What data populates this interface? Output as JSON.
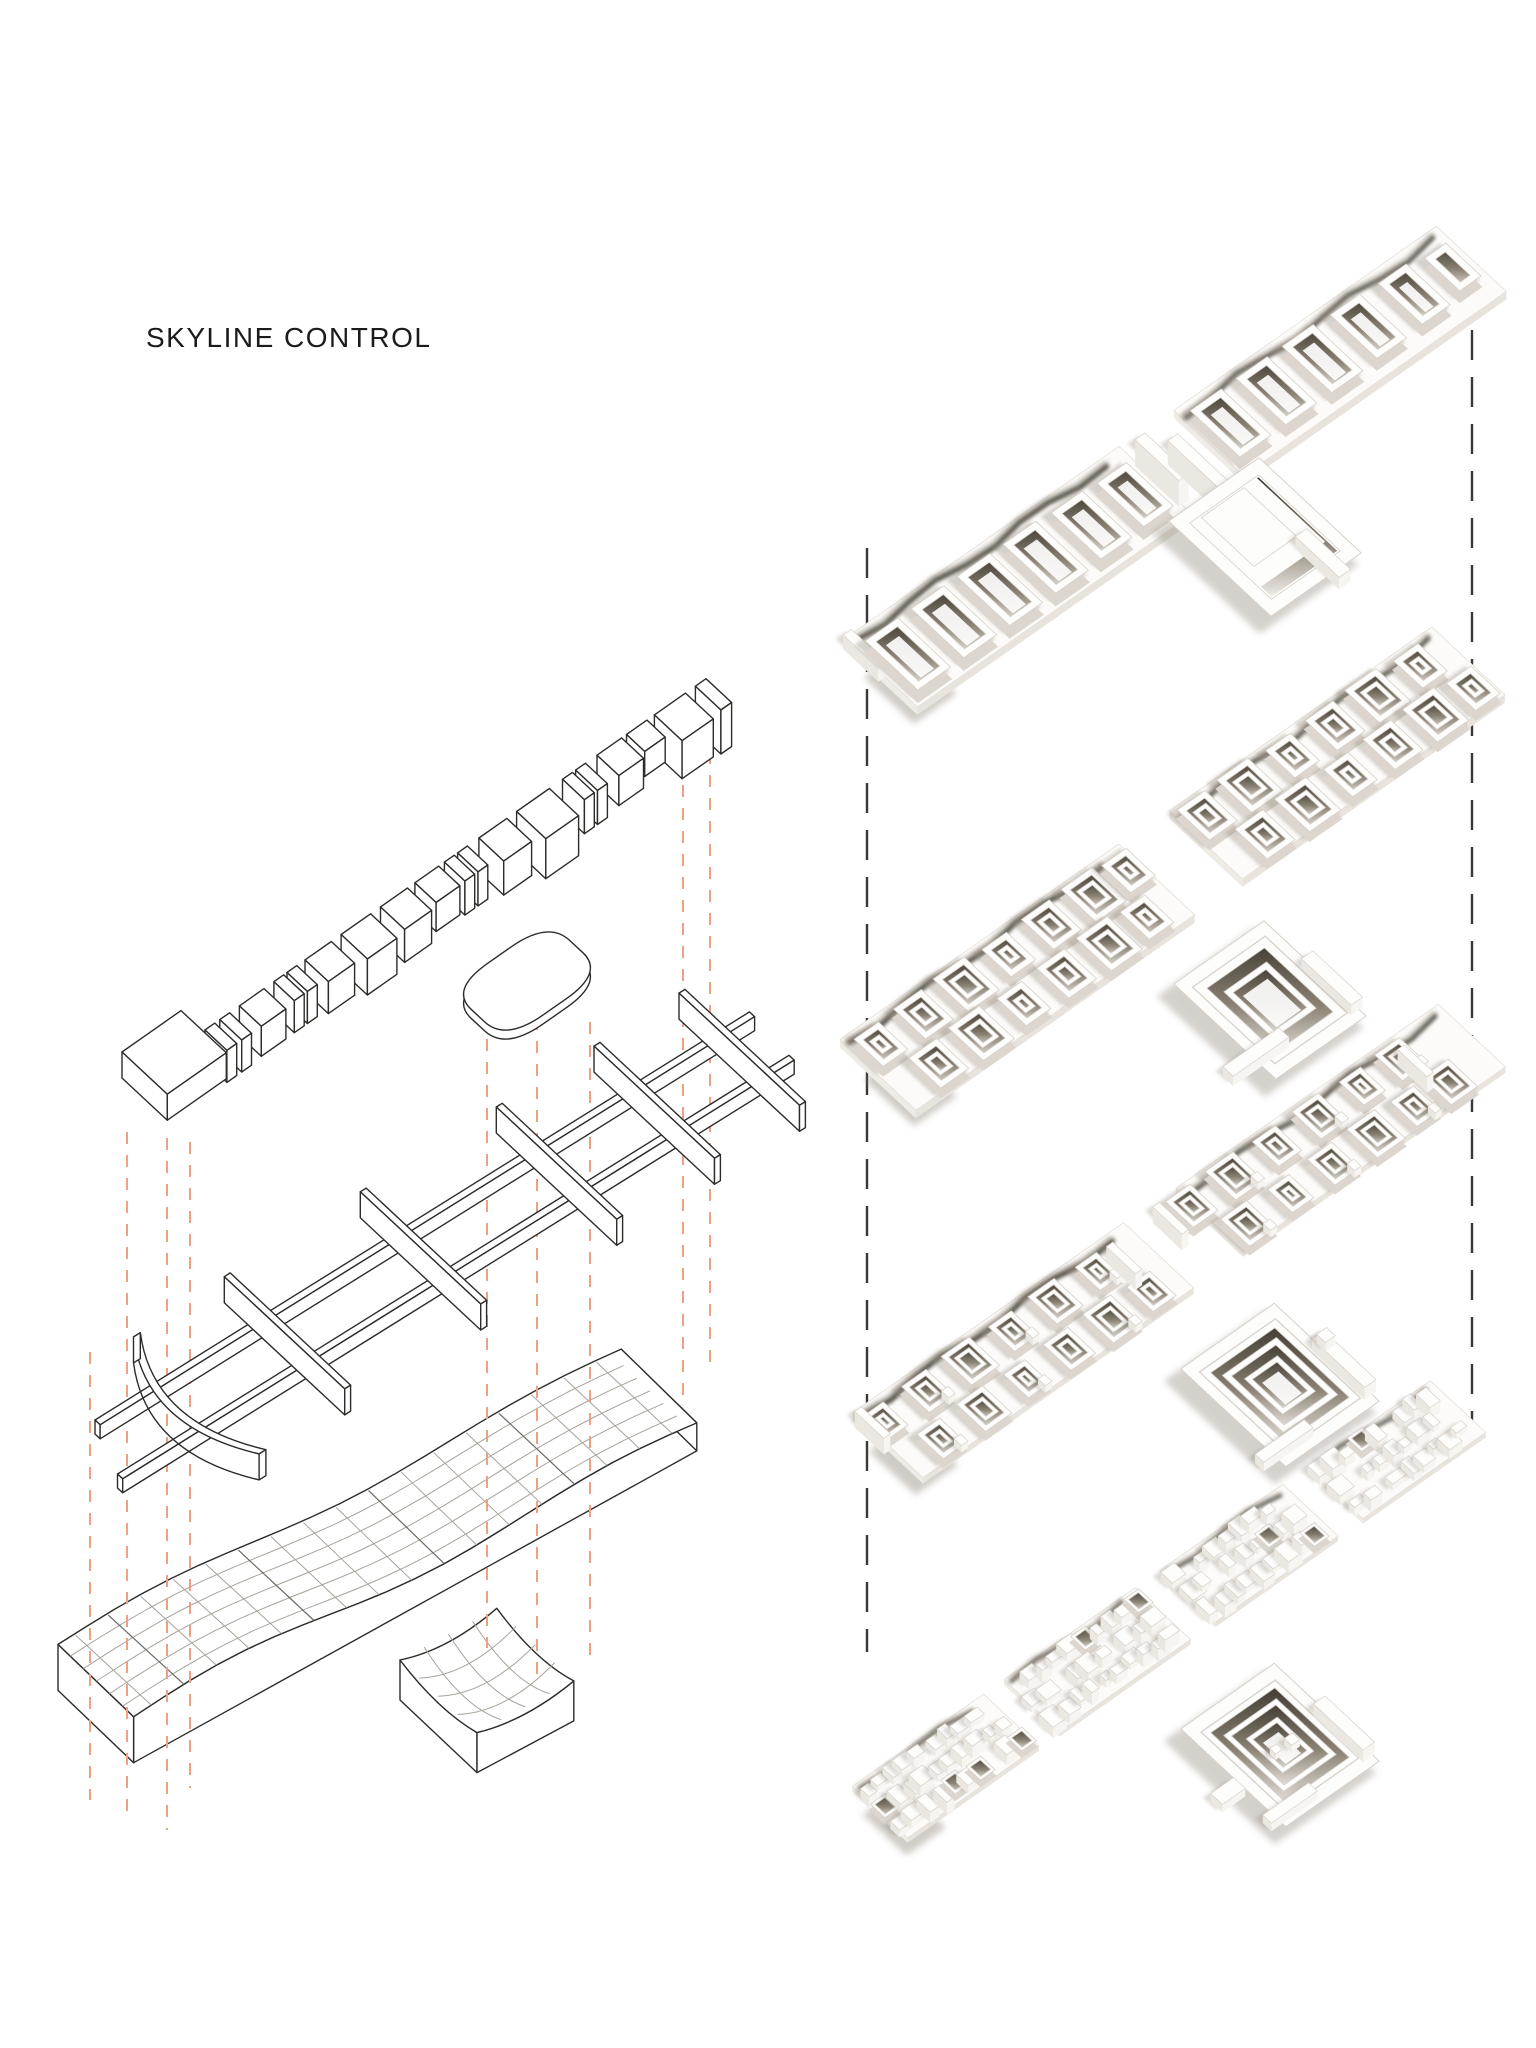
{
  "title": "SKYLINE CONTROL",
  "colors": {
    "background": "#ffffff",
    "ink": "#2e2c29",
    "projection_dash": "#eda084",
    "guide_dash": "#3a3836",
    "mesh_line": "#a8a29a",
    "mesh_line_dark": "#6e6962",
    "render_white": "#fdfdfc",
    "render_edge": "#d6d1c9",
    "render_base": "#dcd6ce",
    "courtyard_dark": "#3a352c",
    "courtyard_mid": "#8b8375",
    "courtyard_light": "#f0ede8",
    "shadow_soft": "#968d80",
    "shadow_band": "#39342b"
  }
}
